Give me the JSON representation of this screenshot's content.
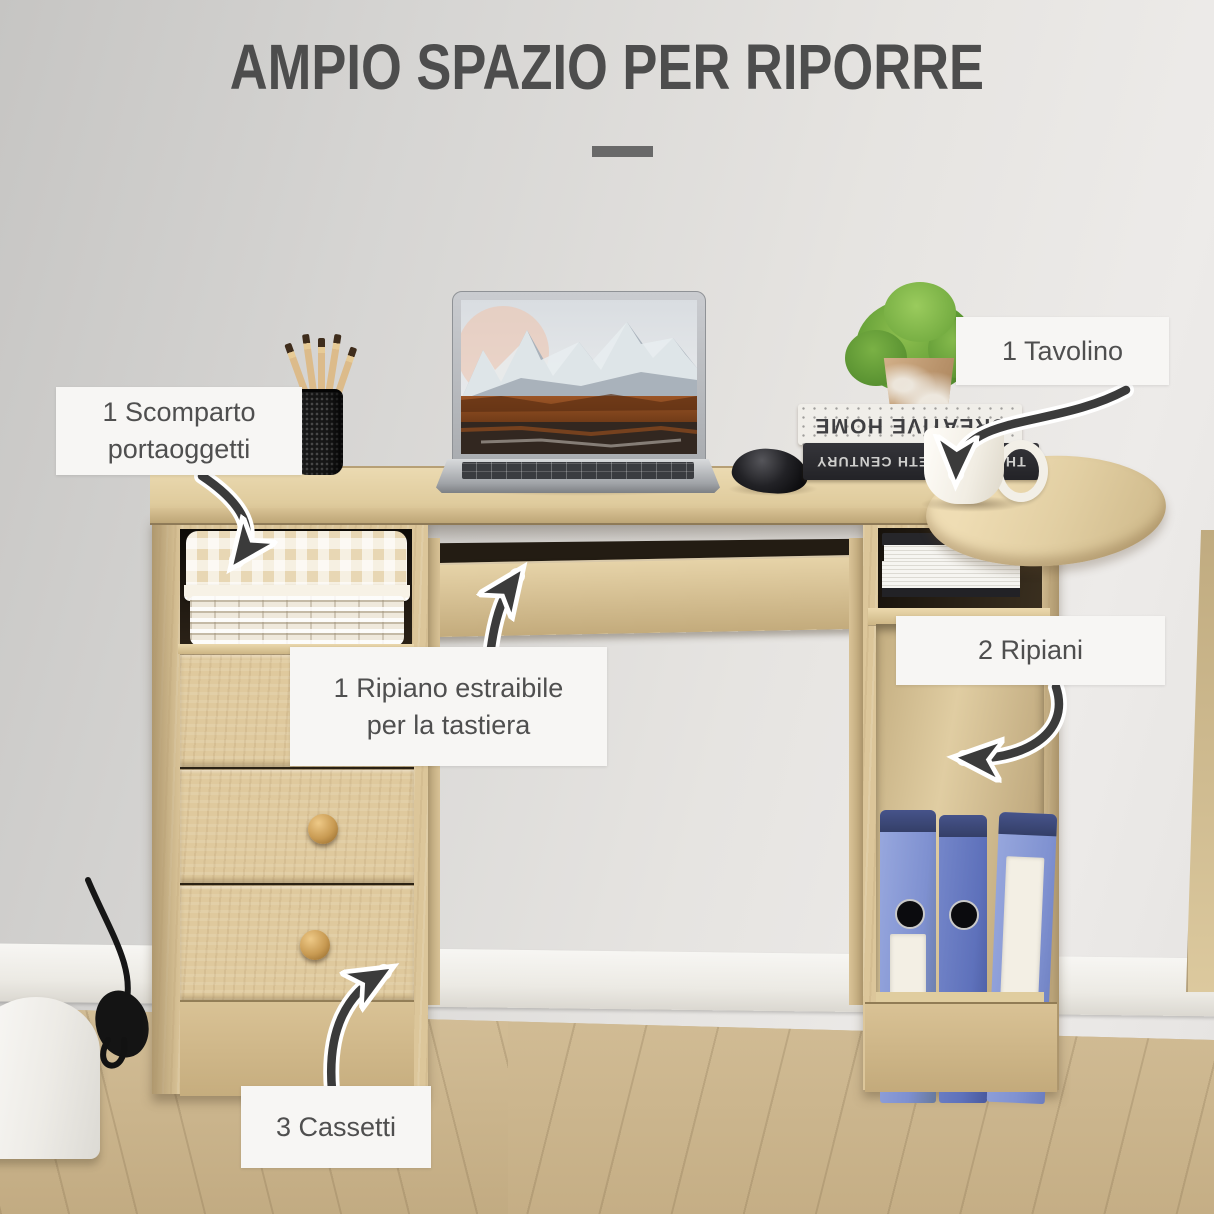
{
  "title": {
    "text": "AMPIO SPAZIO PER RIPORRE"
  },
  "callouts": {
    "scomparto": {
      "line1": "1 Scomparto",
      "line2": "portaoggetti"
    },
    "tavolino": {
      "label": "1 Tavolino"
    },
    "tastiera": {
      "line1": "1 Ripiano estraibile",
      "line2": "per la tastiera"
    },
    "ripiani": {
      "label": "2 Ripiani"
    },
    "cassetti": {
      "label": "3 Cassetti"
    }
  },
  "scene": {
    "white_book_spine": "CREATIVE HOME",
    "black_book_spine": "THE TWENTIETH CENTURY"
  },
  "colors": {
    "wall": "#e2e1df",
    "floor": "#c9b389",
    "desk_wood": "#dcc69a",
    "label_bg": "#f7f6f4",
    "label_text": "#4f4f4f",
    "title_text": "#4d4d4d",
    "arrow": "#3b3b3b",
    "binder_blue": "#8a9bd6",
    "basket_liner": "#e8d7b4"
  }
}
